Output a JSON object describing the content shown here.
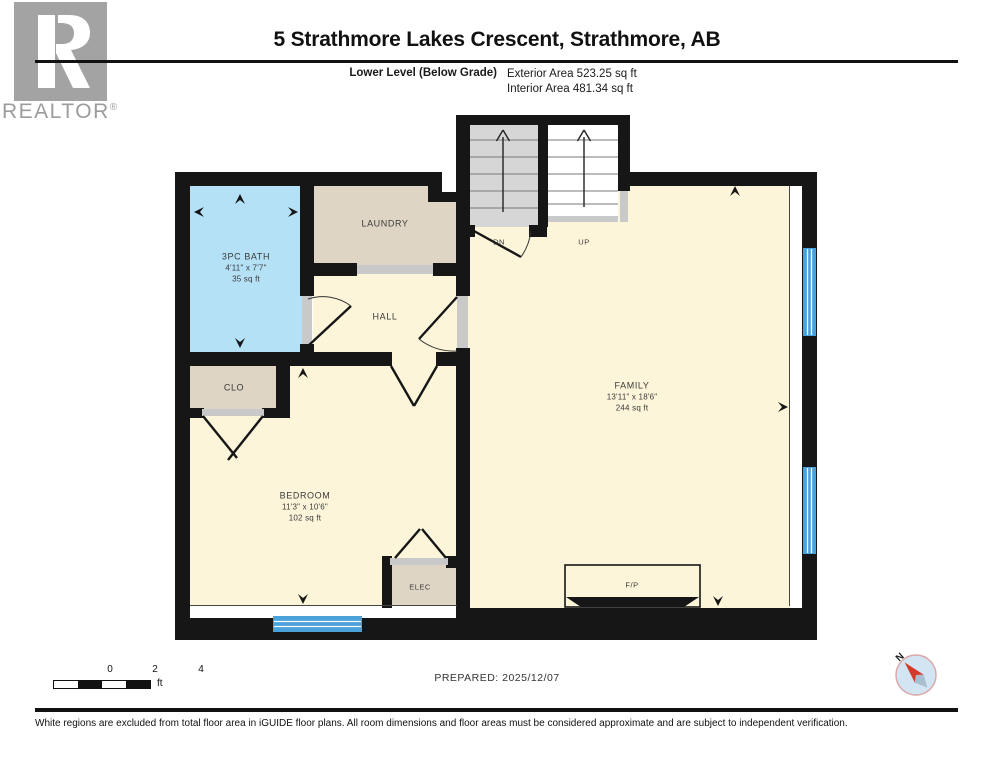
{
  "header": {
    "brand": "REALTOR",
    "brand_reg": "®",
    "title": "5 Strathmore Lakes Crescent, Strathmore, AB",
    "level_label": "Lower Level (Below Grade)",
    "exterior_area": "Exterior Area 523.25 sq ft",
    "interior_area": "Interior Area 481.34 sq ft"
  },
  "plan": {
    "rooms": {
      "bath": {
        "name": "3PC BATH",
        "dims": "4'11\" x 7'7\"",
        "area": "35 sq ft"
      },
      "laundry": {
        "name": "LAUNDRY"
      },
      "hall": {
        "name": "HALL"
      },
      "closet": {
        "name": "CLO"
      },
      "bedroom": {
        "name": "BEDROOM",
        "dims": "11'3\" x 10'6\"",
        "area": "102 sq ft"
      },
      "family": {
        "name": "FAMILY",
        "dims": "13'11\" x 18'6\"",
        "area": "244 sq ft"
      },
      "elec": {
        "name": "ELEC"
      },
      "fireplace": {
        "name": "F/P"
      }
    },
    "stairs": {
      "down_label": "DN",
      "up_label": "UP"
    }
  },
  "footer": {
    "scale": {
      "ticks": [
        "0",
        "2",
        "4"
      ],
      "unit": "ft"
    },
    "prepared": "PREPARED: 2025/12/07",
    "compass_label": "N",
    "disclaimer": "White regions are excluded from total floor area in iGUIDE floor plans. All room dimensions and floor areas must be considered approximate and are subject to independent verification."
  },
  "colors": {
    "wall": "#161616",
    "room-cream": "#fcf5da",
    "room-beige": "#ded5c4",
    "room-blue": "#b4e1f6",
    "stair-gray": "#d6d6d6",
    "window-blue": "#4aa2d9",
    "sill-gray": "#c9c9c9",
    "brand-gray": "#9c9c9c",
    "text-room": "#3a3a3a",
    "compass-red": "#d43a2a",
    "compass-fill": "#d3e5f2",
    "compass-ring": "#dba8a8"
  }
}
